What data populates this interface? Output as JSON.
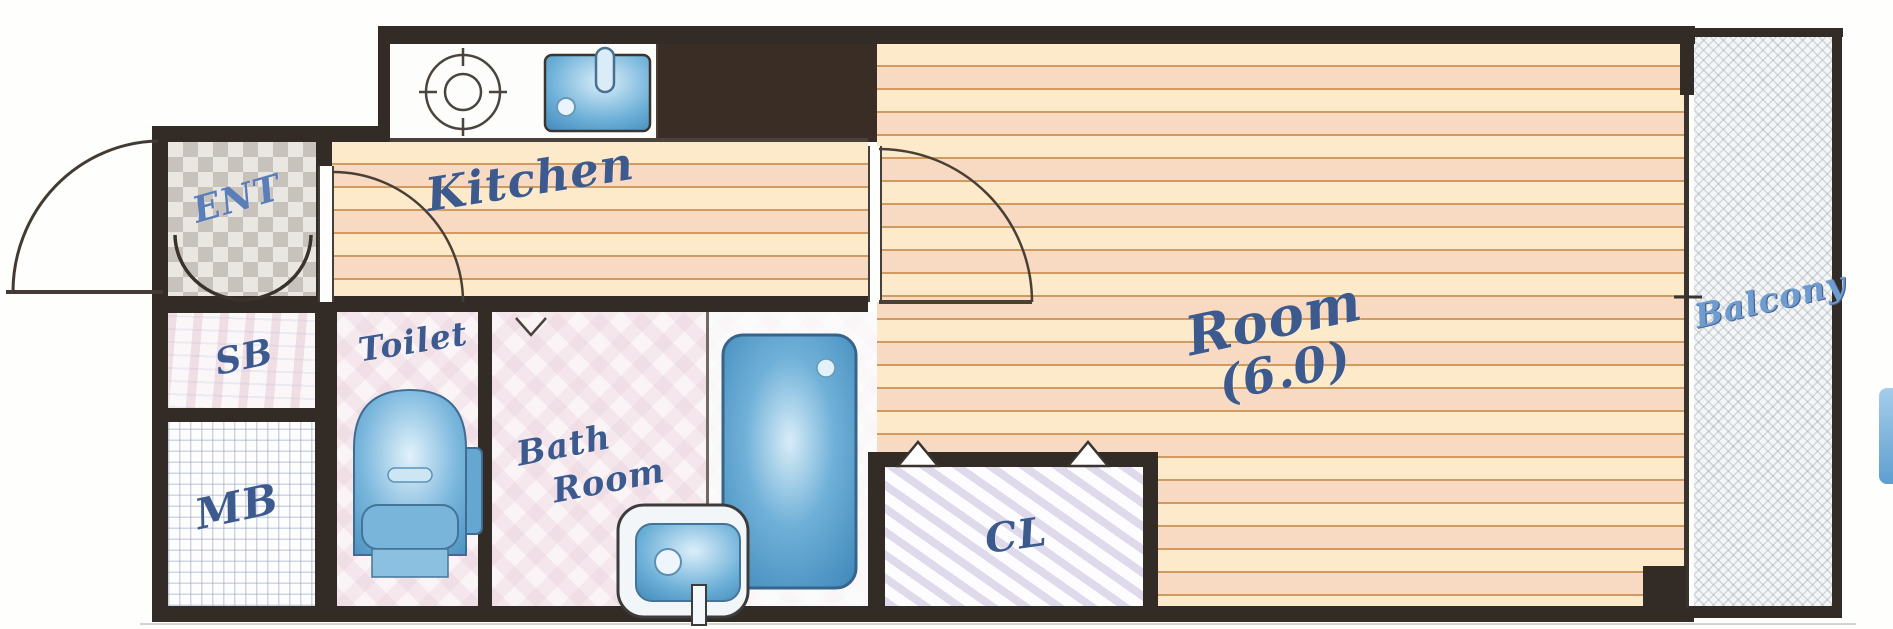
{
  "plan": {
    "title": "1K apartment floor plan",
    "rooms": {
      "ent": {
        "label": "ENT"
      },
      "kitchen": {
        "label": "Kitchen"
      },
      "sb": {
        "label": "SB"
      },
      "mb": {
        "label": "MB"
      },
      "toilet": {
        "label": "Toilet"
      },
      "bath": {
        "label_line1": "Bath",
        "label_line2": "Room"
      },
      "cl": {
        "label": "CL"
      },
      "main_room": {
        "label_line1": "Room",
        "label_line2": "(6.0)"
      },
      "balcony": {
        "label": "Balcony"
      }
    },
    "fixtures": [
      "stove-burner",
      "kitchen-sink",
      "toilet",
      "bathtub",
      "washbasin"
    ],
    "colors": {
      "wall_dark": "#332c26",
      "floor_base": "#fbe3c2",
      "floor_stripe": "#d09a61",
      "fixture_blue": "#5b9fcb",
      "label_blue": "#3d5a8f",
      "ent_label_blue": "#5b7db8",
      "balcony_label_blue": "#6f9cd0"
    }
  }
}
